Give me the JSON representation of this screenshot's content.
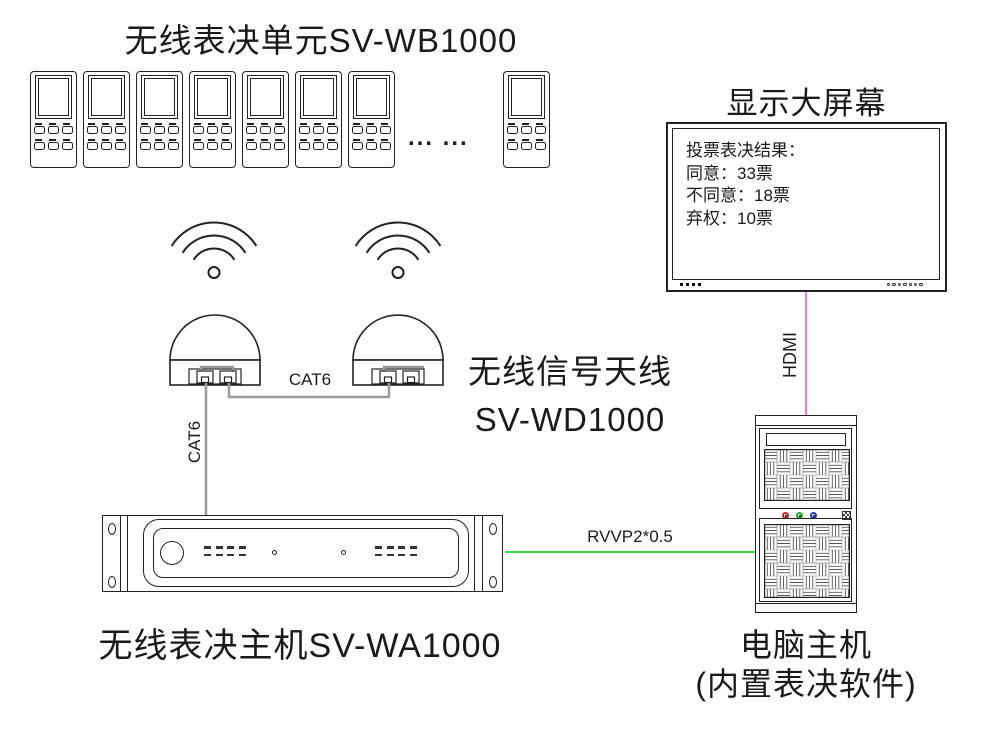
{
  "labels": {
    "unit_title": "无线表决单元SV-WB1000",
    "screen_title": "显示大屏幕",
    "antenna1": "无线信号天线",
    "antenna2": "SV-WD1000",
    "host_title": "无线表决主机SV-WA1000",
    "pc1": "电脑主机",
    "pc2": "(内置表决软件)"
  },
  "screen": {
    "lines": [
      "投票表决结果：",
      "同意：33票",
      "不同意：18票",
      "弃权：10票"
    ]
  },
  "cables": {
    "cat6_between_antennas": "CAT6",
    "cat6_to_host": "CAT6",
    "hdmi": "HDMI",
    "rvvp": "RVVP2*0.5"
  },
  "misc": {
    "ellipsis": "... ..."
  },
  "colors": {
    "hdmi": "#f970f9",
    "rvvp": "#3ed43e",
    "cable": "#9a9a9a",
    "led_red": "#cc2222",
    "led_green": "#22aa22",
    "led_blue": "#2233cc"
  }
}
